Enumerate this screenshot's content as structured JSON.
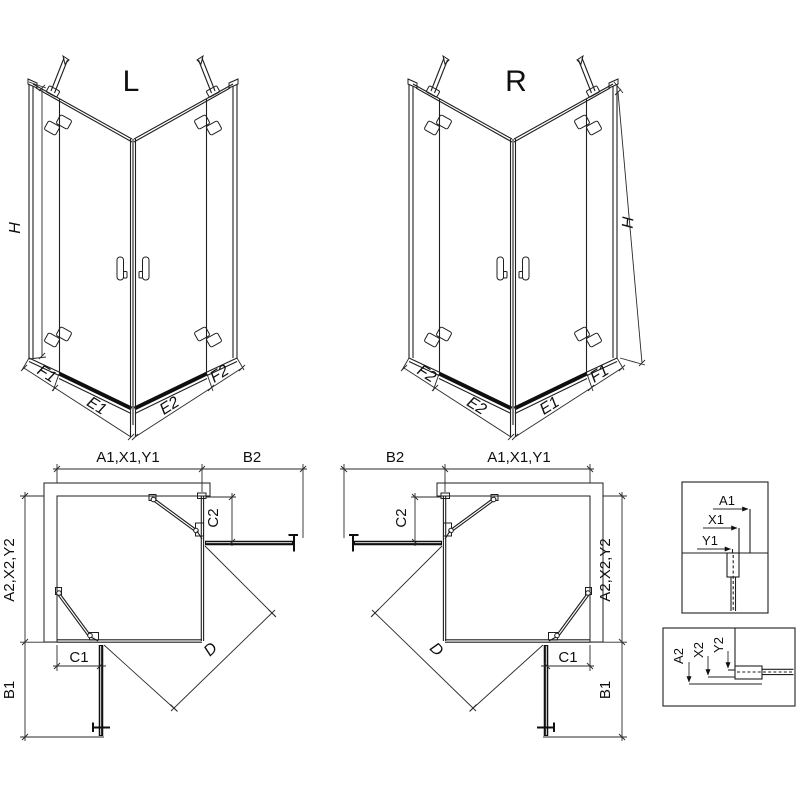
{
  "drawing": {
    "title_left": "L",
    "title_right": "R",
    "dims": {
      "height": "H",
      "f1": "F1",
      "e1": "E1",
      "e2": "E2",
      "f2": "F2",
      "top_width": "A1,X1,Y1",
      "side_depth": "A2,X2,Y2",
      "b1": "B1",
      "b2": "B2",
      "c1": "C1",
      "c2": "C2",
      "diagonal": "D"
    },
    "detail_top": {
      "a1": "A1",
      "x1": "X1",
      "y1": "Y1"
    },
    "detail_bottom": {
      "a2": "A2",
      "x2": "X2",
      "y2": "Y2"
    }
  },
  "colors": {
    "line": "#1f1f1f",
    "dim": "#2a2a2a",
    "dark": "#0f0f0f",
    "hatch": "#3a3a3a",
    "background": "#ffffff"
  }
}
